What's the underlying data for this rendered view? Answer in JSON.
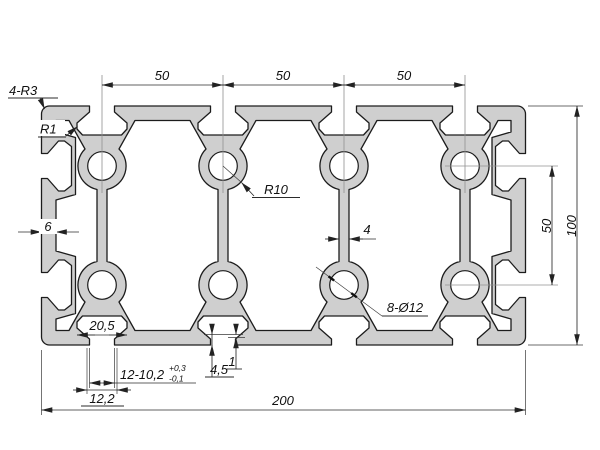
{
  "drawing": {
    "type": "technical-drawing",
    "subject": "aluminium profile cross-section 200x100",
    "colors": {
      "background": "#ffffff",
      "profile_fill": "#cfcfcf",
      "outline": "#1c1c1c",
      "dimension_line": "#2b2b2b",
      "centerline": "#909090",
      "text": "#111111"
    },
    "dimensions": {
      "top_spacing_1": "50",
      "top_spacing_2": "50",
      "top_spacing_3": "50",
      "hole_row_spacing": "50",
      "overall_height": "100",
      "overall_width": "200",
      "wall_thickness": "6",
      "web_thickness": "4",
      "slot_cavity_width": "20,5",
      "slot_spec_main": "12-10,2",
      "slot_spec_tol_plus": "+0,3",
      "slot_spec_tol_minus": "-0,1",
      "slot_outer_width": "12,2",
      "lip_depth": "4,5",
      "lip_step": "1"
    },
    "labels": {
      "corner_radius": "4-R3",
      "lip_radius": "R1",
      "boss_radius": "R10",
      "holes": "8-Ø12"
    }
  }
}
